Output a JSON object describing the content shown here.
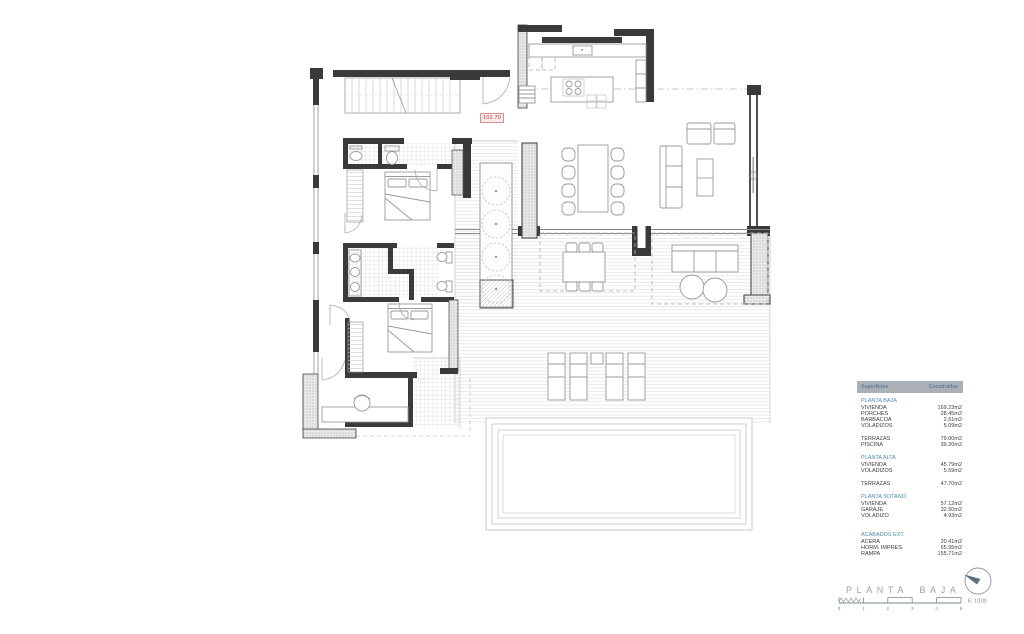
{
  "plan": {
    "level_label": "102.70"
  },
  "legend": {
    "header": {
      "col1": "Superficies",
      "col2": "Construidas"
    },
    "sections": [
      {
        "title": "PLANTA BAJA",
        "rows": [
          [
            "VIVIENDA",
            "169.23m2"
          ],
          [
            "PORCHES",
            "28.45m2"
          ],
          [
            "BARBACOA",
            "2.61m2"
          ],
          [
            "VOLADIZOS",
            "5.09m2"
          ]
        ]
      },
      {
        "title": "",
        "rows": [
          [
            "TERRAZAS",
            "79.00m2"
          ],
          [
            "PISCINA",
            "39.20m2"
          ]
        ]
      },
      {
        "title": "PLANTA ALTA",
        "rows": [
          [
            "VIVIENDA",
            "45.79m2"
          ],
          [
            "VOLADIZOS",
            "5.59m2"
          ]
        ]
      },
      {
        "title": "",
        "rows": [
          [
            "TERRAZAS",
            "47.70m2"
          ]
        ]
      },
      {
        "title": "PLANTA SOTANO",
        "rows": [
          [
            "VIVIENDA",
            "57.12m2"
          ],
          [
            "GARAJE",
            "32.50m2"
          ],
          [
            "VOLADIZO",
            "4.93m2"
          ]
        ]
      },
      {
        "title": "ACABADOS EXT.",
        "rows": [
          [
            "ACERA",
            "20.41m2"
          ],
          [
            "HORM. IMPRES.",
            "65.95m2"
          ],
          [
            "RAMPA",
            "155.71m2"
          ]
        ]
      }
    ]
  },
  "footer": {
    "title": "PLANTA BAJA",
    "scale_label": "E: 1/100",
    "scale_ticks": [
      "0",
      "1",
      "2",
      "3",
      "4",
      "5"
    ]
  },
  "colors": {
    "section_blue": "#4e8ab5",
    "header_bar_gray": "#abb0b6",
    "level_label_red": "#c03c3c",
    "wall_dark": "#3a3a3a",
    "compass_slate": "#5d6f7d",
    "title_gray": "#9aa0a4"
  }
}
